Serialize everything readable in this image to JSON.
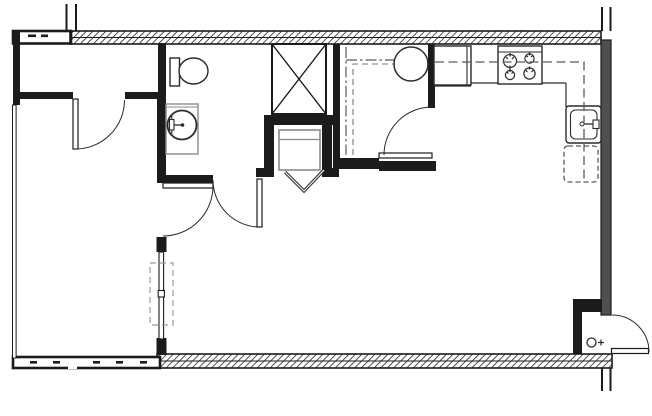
{
  "drawing": {
    "kind": "architectural-floor-plan",
    "visible_text": "",
    "wall_types": {
      "hatched": "exterior-insulated-wall",
      "solid_black": "interior-partition-wall",
      "solid_gray": "corridor-demising-wall",
      "thin_double": "window-or-slider-panel"
    }
  },
  "colors": {
    "background": "#ffffff",
    "line": "#1b1b1b",
    "wall_fill": "#1b1b1b",
    "gray_wall": "#4f4f4f",
    "object_gray": "#8a8a8a",
    "dash_gray": "#5a5a5a",
    "arc_line": "#2a2a2a"
  },
  "fixtures": [
    {
      "name": "toilet",
      "room": "bathroom"
    },
    {
      "name": "round-lavatory-sink",
      "room": "bathroom"
    },
    {
      "name": "x-box-chase",
      "room": "mechanical"
    },
    {
      "name": "appliance-with-bifold-door",
      "room": "alcove"
    },
    {
      "name": "water-heater-circle",
      "room": "utility-closet"
    },
    {
      "name": "shelf-and-rod-dashed-lines",
      "room": "utility-closet"
    },
    {
      "name": "refrigerator",
      "room": "kitchen"
    },
    {
      "name": "range-4-burner",
      "room": "kitchen"
    },
    {
      "name": "kitchen-sink-with-faucet",
      "room": "kitchen"
    },
    {
      "name": "dishwasher-dashed",
      "room": "kitchen"
    },
    {
      "name": "upper-cabinet-dashed-line",
      "room": "kitchen"
    },
    {
      "name": "entry-door-symbol-circle",
      "room": "entry"
    },
    {
      "name": "sliding-window-panel",
      "room": "bedroom-wall"
    }
  ],
  "doors": [
    {
      "name": "closet-door",
      "swing": "down-left"
    },
    {
      "name": "bedroom-door",
      "swing": "east-into-living"
    },
    {
      "name": "bathroom-door",
      "swing": "south-into-hall"
    },
    {
      "name": "utility-closet-door",
      "swing": "west-into-closet"
    },
    {
      "name": "unit-entry-door",
      "swing": "out-east-to-corridor"
    }
  ]
}
